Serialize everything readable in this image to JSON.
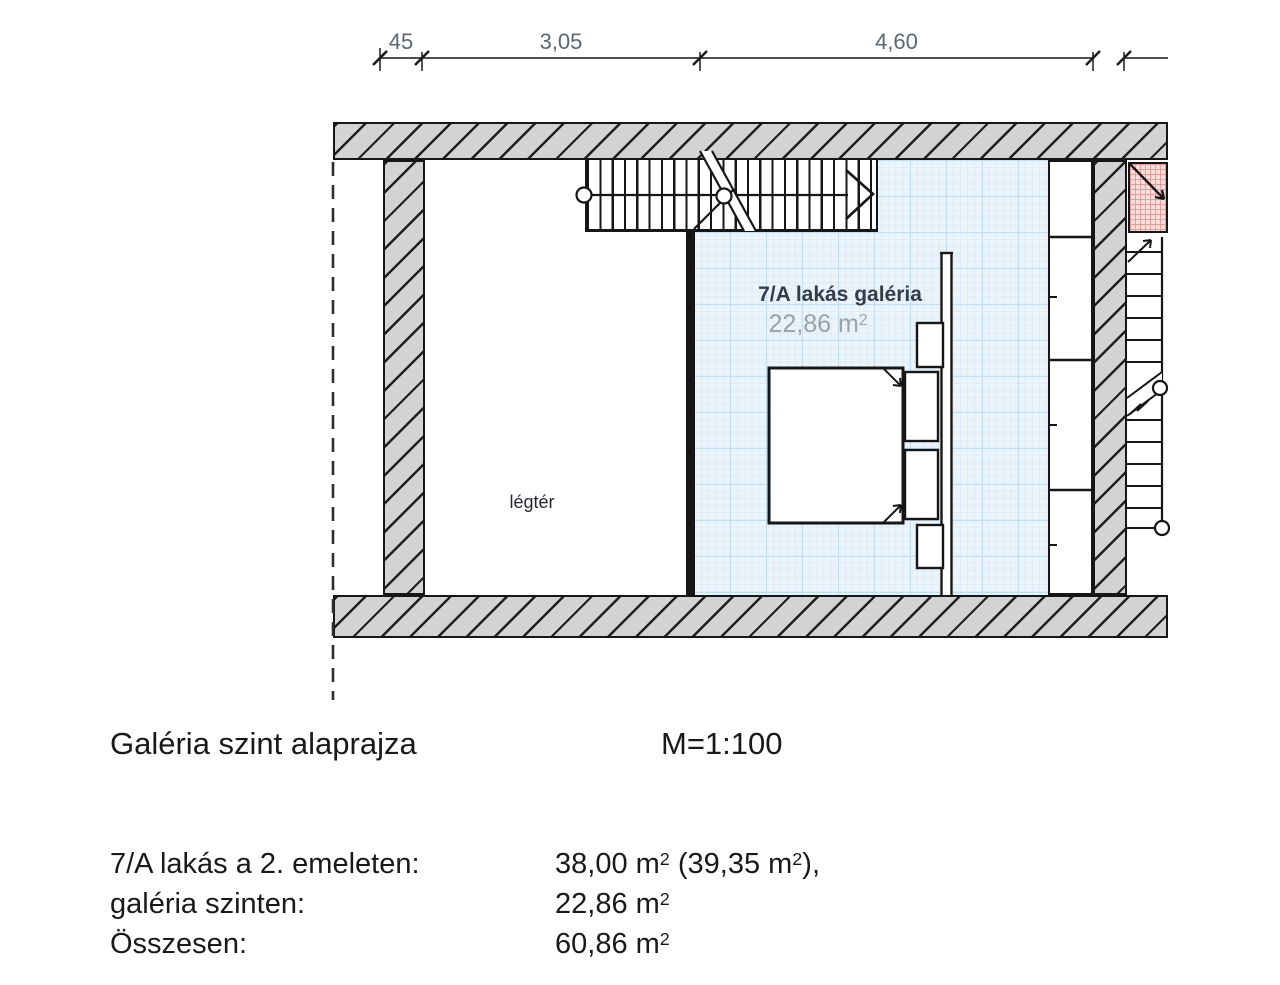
{
  "title_block": {
    "title": "Galéria szint alaprajza",
    "scale": "M=1:100"
  },
  "dimensions": {
    "seg1": "45",
    "seg2": "3,05",
    "seg3": "4,60"
  },
  "rooms": {
    "gallery": {
      "name": "7/A lakás galéria",
      "area": "22,86 m",
      "area_sup": "2"
    },
    "void": {
      "name": "légtér"
    }
  },
  "area_summary": {
    "rows": [
      {
        "label": "7/A lakás a 2. emeleten:",
        "v1": "38,00 m",
        "s1": "2",
        "v2": " (39,35 m",
        "s2": "2",
        "v3": "),"
      },
      {
        "label": "galéria szinten:",
        "v1": "22,86 m",
        "s1": "2",
        "v2": "",
        "s2": "",
        "v3": ""
      },
      {
        "label": "Összesen:",
        "v1": "60,86 m",
        "s1": "2",
        "v2": "",
        "s2": "",
        "v3": ""
      }
    ]
  },
  "colors": {
    "wall_fill": "#d3d3d3",
    "hatch_line": "#1f1f1f",
    "gallery_fill": "#ecf4fb",
    "gallery_grid": "#c3ddf0",
    "shaft_red_fill": "#f9dfdc",
    "shaft_red_grid": "#e49d98",
    "line": "#161616",
    "dim_text": "#5d6672",
    "area_value_text": "#99a1a9"
  }
}
